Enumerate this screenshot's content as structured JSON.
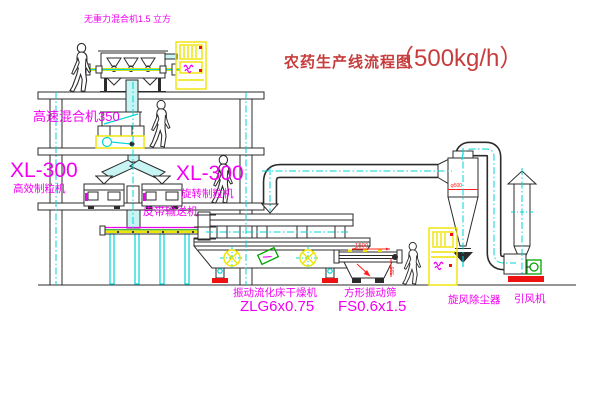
{
  "title": {
    "name": "农药生产线流程图",
    "capacity": "（500kg/h）"
  },
  "equipment_labels": {
    "top_mixer": "无重力混合机1.5 立方",
    "high_speed_mixer": "高速混合机350",
    "granulator_left": {
      "model": "XL-300",
      "name": "高效制粒机"
    },
    "granulator_mid": {
      "model": "XL-300",
      "name": "旋转制粒机"
    },
    "belt_conveyor": "皮带输送机",
    "fluid_bed_dryer": {
      "name": "振动流化床干燥机",
      "model": "ZLG6x0.75"
    },
    "vibrating_sieve": {
      "name": "方形振动筛",
      "model": "FS0.6x1.5"
    },
    "cyclone": "旋风除尘器",
    "induced_draft_fan": "引风机"
  },
  "dimensions": {
    "sieve_length": "1500",
    "sieve_height": "595",
    "cyclone_note": "φ500"
  },
  "colors": {
    "line_black": "#2b2b2b",
    "label_magenta": "#f000f0",
    "title_red": "#c73c3c",
    "dim_red": "#ff2020",
    "accent_cyan": "#00d4d4",
    "pipe_fill": "#c9f4f4",
    "accent_yellow": "#eee400",
    "accent_green": "#00a400",
    "accent_red": "#ee1111"
  }
}
